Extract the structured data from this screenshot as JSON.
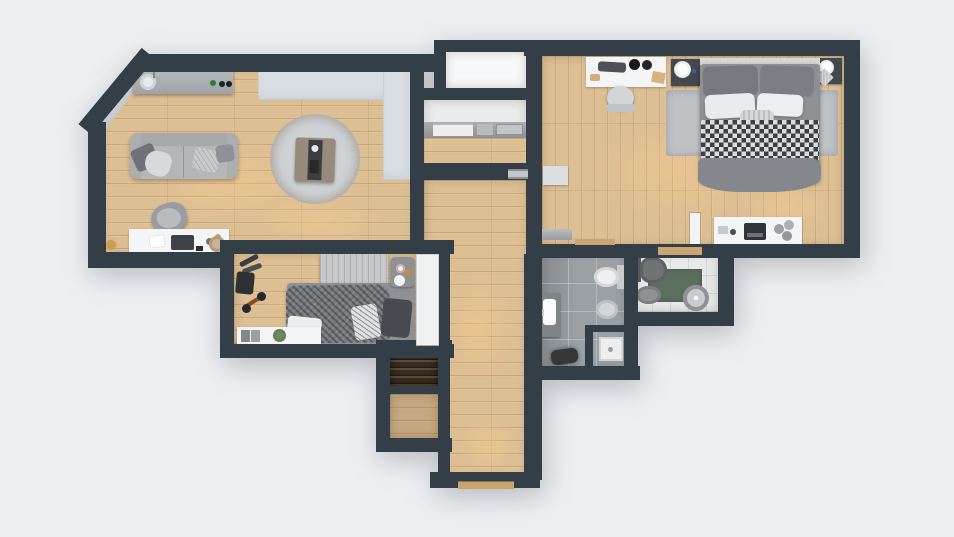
{
  "scene": {
    "type": "apartment-floor-plan",
    "view": "top-down-3d-render",
    "width_px": 954,
    "height_px": 537
  },
  "colors": {
    "background": "#edeff2",
    "wall": "#333e47",
    "wood": "#ddbf94",
    "wood_dark": "#c2a074",
    "tile_gray": "#9ba0a4",
    "tile_light": "#e7e9ea",
    "white": "#f4f5f6",
    "soft_gray": "#d9dee3",
    "counter": "#a7abae",
    "sofa": "#b4b6b8",
    "rug": "#c7c9cb",
    "bed_gray": "#8d9194",
    "check_dark": "#3c4043",
    "green_mat": "#5c6e5e",
    "dark_shelf": "#352c20",
    "threshold_tan": "#c9a671",
    "dark_item": "#2f3235",
    "bike_accent": "#8a4a26",
    "glow": "rgba(255,205,140,0.34)"
  },
  "rooms": [
    {
      "id": "living-room",
      "label": "living-room-with-kitchenette"
    },
    {
      "id": "utility-closet",
      "label": "utility-closet"
    },
    {
      "id": "storage-niche",
      "label": "storage-niche"
    },
    {
      "id": "hallway",
      "label": "hallway"
    },
    {
      "id": "master-bedroom",
      "label": "master-bedroom"
    },
    {
      "id": "second-bedroom",
      "label": "second-bedroom"
    },
    {
      "id": "bathroom",
      "label": "bathroom"
    },
    {
      "id": "toilet-room",
      "label": "toilet-room"
    },
    {
      "id": "closet-shelving",
      "label": "closet-with-shelving"
    },
    {
      "id": "closet-wardrobe",
      "label": "closet-storage"
    }
  ],
  "furniture": {
    "living_room": [
      "kitchen-counter",
      "kitchen-sink",
      "cooktop-knobs",
      "built-in-cabinet",
      "sofa",
      "throw-pillows",
      "round-rug",
      "coffee-table",
      "work-desk",
      "laptop",
      "desk-chair",
      "floor-lamp",
      "basket"
    ],
    "second_bedroom": [
      "headboard",
      "bed",
      "knit-blanket",
      "cushions",
      "tray-stool",
      "console-table",
      "plant",
      "exercise-bike",
      "dumbbell-rack",
      "yoga-mat",
      "wardrobe-panel"
    ],
    "master_bedroom": [
      "double-bed",
      "checkered-duvet",
      "pillows",
      "area-rug",
      "nightstand-left",
      "nightstand-right",
      "table-lamps",
      "vanity-desk",
      "desk-chair",
      "dresser",
      "decor-vases",
      "typewriter",
      "sideboard",
      "radiator-cabinet",
      "door-leaf"
    ],
    "bathroom": [
      "toilet",
      "bidet",
      "sink-vanity",
      "shower-enclosure",
      "shower-tray",
      "bath-mat"
    ],
    "toilet_room": [
      "toilet",
      "wall-sink",
      "green-mat",
      "round-basin"
    ],
    "utility_closet": [
      "appliance-counter",
      "washer",
      "small-appliances"
    ],
    "hallway": [
      "entrance-threshold",
      "door-threshold"
    ]
  }
}
